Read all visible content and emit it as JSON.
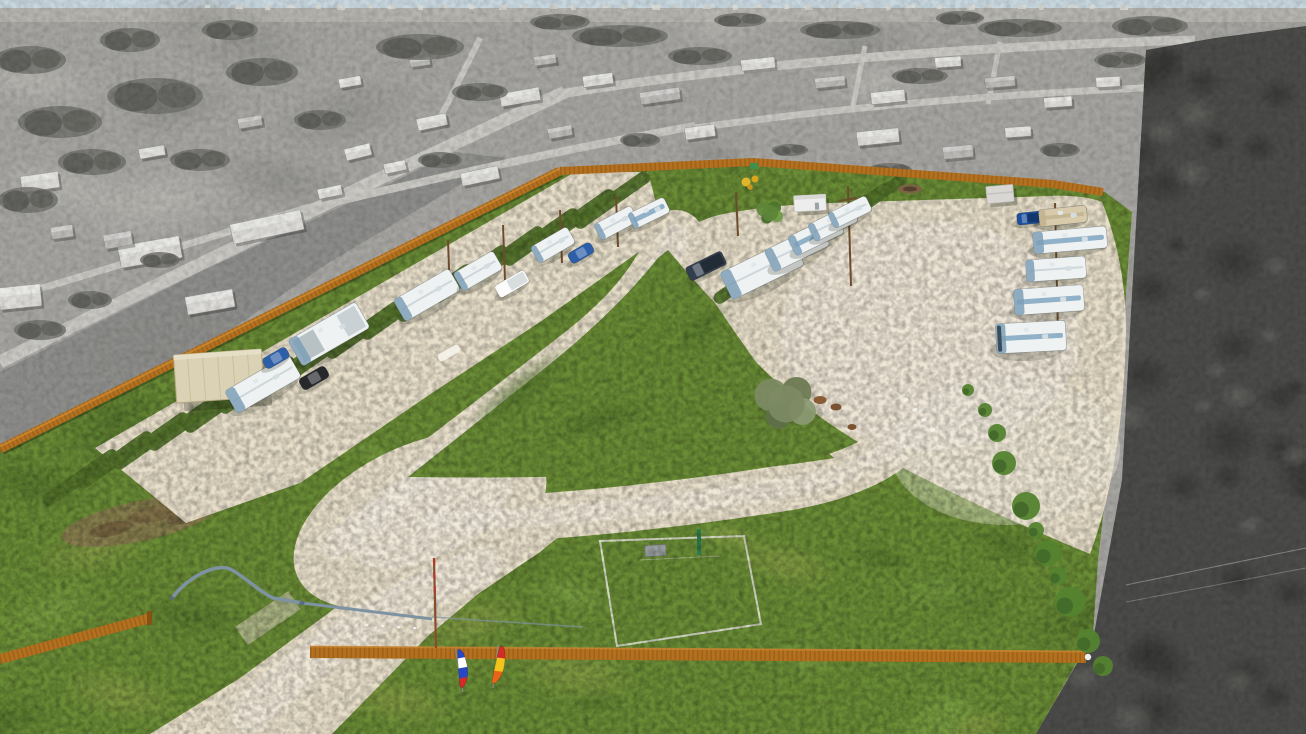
{
  "meta": {
    "description": "Aerial drone photograph of an RV park campground, shown in color while the surrounding rural neighborhood and woods are desaturated grayscale",
    "style": "color-pop isolation photo, no visible text"
  },
  "palette": {
    "sky": "#c8d6de",
    "field": "#a5a4a0",
    "fieldLight": "#b9b8b2",
    "asphalt": "#8b8b88",
    "road": "#c9c8c3",
    "bldgLight": "#deddd9",
    "bldgMid": "#bcbbb7",
    "gsTree": "#6f6f6b",
    "gsTreeDark": "#5b5b57",
    "woods": "#4b4b49",
    "woodsDark": "#383836",
    "woodsLight": "#656562",
    "grass": "#6a8c36",
    "grassDark": "#52702a",
    "grassLight": "#7da244",
    "grassYellow": "#8f9e4a",
    "gravel": "#e8dfca",
    "gravelLight": "#f3eee2",
    "fence": "#b3701f",
    "fenceDark": "#855114",
    "fenceLight": "#d08e38",
    "rvWhite": "#eff2f2",
    "rvTan": "#d8cbab",
    "accent": "#7fa6bf",
    "shadow": "rgba(30,35,20,0.38)",
    "carBlue": "#2d5fa8",
    "carBlack": "#26282b",
    "carWhite": "#fbfbfa",
    "truckDark": "#333f4e",
    "truckBlue": "#1c4f9c",
    "metal": "#7e93a2",
    "carportRoof": "#dbd2b6",
    "shed": "#d8d7d3",
    "office": "#ecedec",
    "poleBrown": "#6d4c2e",
    "debris": "#8b7852",
    "courtLine": "#e9e9e2",
    "postGreen": "#2f7d50",
    "sign": "#3f8f4f",
    "marking": "#f6f4ec"
  },
  "scene": {
    "gs_buildings": [
      [
        40,
        182,
        38,
        16,
        -8,
        "l"
      ],
      [
        150,
        252,
        62,
        22,
        -10,
        "l"
      ],
      [
        267,
        227,
        72,
        20,
        -12,
        "l"
      ],
      [
        20,
        297,
        42,
        22,
        -6,
        "l"
      ],
      [
        118,
        240,
        28,
        14,
        -10,
        "m"
      ],
      [
        358,
        152,
        26,
        12,
        -14,
        "l"
      ],
      [
        432,
        122,
        30,
        12,
        -12,
        "l"
      ],
      [
        520,
        97,
        40,
        13,
        -10,
        "l"
      ],
      [
        598,
        80,
        30,
        11,
        -8,
        "l"
      ],
      [
        660,
        96,
        40,
        12,
        -8,
        "m"
      ],
      [
        758,
        64,
        34,
        11,
        -6,
        "l"
      ],
      [
        830,
        82,
        30,
        10,
        -6,
        "m"
      ],
      [
        888,
        97,
        34,
        12,
        -6,
        "l"
      ],
      [
        948,
        62,
        26,
        10,
        -4,
        "l"
      ],
      [
        1000,
        82,
        30,
        10,
        -5,
        "m"
      ],
      [
        1058,
        102,
        28,
        10,
        -4,
        "l"
      ],
      [
        1108,
        82,
        24,
        10,
        -3,
        "l"
      ],
      [
        878,
        137,
        42,
        14,
        -6,
        "l"
      ],
      [
        958,
        152,
        30,
        12,
        -5,
        "m"
      ],
      [
        1018,
        132,
        26,
        10,
        -4,
        "l"
      ],
      [
        700,
        132,
        30,
        12,
        -8,
        "l"
      ],
      [
        560,
        132,
        24,
        10,
        -10,
        "m"
      ],
      [
        330,
        192,
        24,
        10,
        -12,
        "l"
      ],
      [
        395,
        167,
        22,
        10,
        -12,
        "l"
      ],
      [
        210,
        302,
        48,
        18,
        -10,
        "l"
      ],
      [
        480,
        176,
        38,
        13,
        -12,
        "l"
      ],
      [
        545,
        60,
        22,
        9,
        -8,
        "m"
      ],
      [
        420,
        62,
        20,
        8,
        -8,
        "m"
      ],
      [
        350,
        82,
        22,
        9,
        -10,
        "l"
      ],
      [
        250,
        122,
        24,
        10,
        -10,
        "m"
      ],
      [
        152,
        152,
        26,
        10,
        -10,
        "l"
      ],
      [
        62,
        232,
        22,
        12,
        -8,
        "m"
      ]
    ],
    "gs_trees": [
      [
        60,
        122,
        42,
        16
      ],
      [
        155,
        96,
        48,
        18
      ],
      [
        262,
        72,
        36,
        14
      ],
      [
        420,
        47,
        44,
        13
      ],
      [
        620,
        36,
        48,
        11
      ],
      [
        840,
        30,
        40,
        9
      ],
      [
        1020,
        28,
        42,
        9
      ],
      [
        1150,
        26,
        38,
        10
      ],
      [
        28,
        200,
        30,
        13
      ],
      [
        92,
        162,
        34,
        13
      ],
      [
        480,
        92,
        28,
        9
      ],
      [
        700,
        56,
        32,
        9
      ],
      [
        920,
        76,
        28,
        8
      ],
      [
        1120,
        60,
        26,
        8
      ],
      [
        200,
        160,
        30,
        11
      ],
      [
        320,
        120,
        26,
        10
      ],
      [
        30,
        60,
        36,
        14
      ],
      [
        130,
        40,
        30,
        12
      ],
      [
        230,
        30,
        28,
        10
      ],
      [
        560,
        22,
        30,
        8
      ],
      [
        740,
        20,
        26,
        7
      ],
      [
        960,
        18,
        24,
        7
      ],
      [
        440,
        160,
        22,
        8
      ],
      [
        640,
        140,
        20,
        7
      ],
      [
        790,
        150,
        18,
        6
      ],
      [
        1060,
        150,
        20,
        7
      ],
      [
        890,
        170,
        22,
        7
      ],
      [
        40,
        330,
        26,
        10
      ],
      [
        90,
        300,
        22,
        9
      ],
      [
        160,
        260,
        20,
        8
      ]
    ],
    "left_dividers": [
      [
        80,
        478
      ],
      [
        115,
        460
      ],
      [
        151,
        441
      ],
      [
        186,
        422
      ],
      [
        222,
        404
      ],
      [
        257,
        385
      ],
      [
        293,
        367
      ],
      [
        328,
        348
      ],
      [
        364,
        330
      ],
      [
        399,
        311
      ],
      [
        435,
        293
      ],
      [
        470,
        274
      ],
      [
        506,
        255
      ],
      [
        541,
        237
      ],
      [
        577,
        218
      ],
      [
        612,
        200
      ]
    ],
    "top_dividers": [
      [
        745,
        280
      ],
      [
        780,
        258
      ],
      [
        807,
        242
      ],
      [
        825,
        229
      ],
      [
        842,
        218
      ],
      [
        859,
        207
      ],
      [
        876,
        197
      ]
    ],
    "poles": [
      [
        448,
        240,
        450,
        296
      ],
      [
        503,
        225,
        505,
        280
      ],
      [
        560,
        210,
        562,
        263
      ],
      [
        616,
        196,
        618,
        247
      ],
      [
        848,
        186,
        851,
        286
      ],
      [
        1055,
        203,
        1058,
        333
      ],
      [
        736,
        192,
        738,
        236
      ]
    ],
    "objects": [
      {
        "t": "carport",
        "x": 219,
        "y": 376,
        "w": 88,
        "h": 48,
        "a": -4
      },
      {
        "t": "rv",
        "x": 263,
        "y": 384,
        "w": 74,
        "h": 26,
        "a": -30,
        "v": "white"
      },
      {
        "t": "car",
        "x": 276,
        "y": 358,
        "w": 27,
        "h": 12,
        "a": -30,
        "v": "blue"
      },
      {
        "t": "car",
        "x": 314,
        "y": 378,
        "w": 30,
        "h": 13,
        "a": -30,
        "v": "black"
      },
      {
        "t": "rv",
        "x": 329,
        "y": 334,
        "w": 78,
        "h": 30,
        "a": -30,
        "v": "gray"
      },
      {
        "t": "rv",
        "x": 427,
        "y": 295,
        "w": 64,
        "h": 25,
        "a": -30,
        "v": "white"
      },
      {
        "t": "rv",
        "x": 478,
        "y": 271,
        "w": 46,
        "h": 21,
        "a": -30,
        "v": "white"
      },
      {
        "t": "truck",
        "x": 512,
        "y": 284,
        "w": 34,
        "h": 14,
        "a": -30,
        "v": "white"
      },
      {
        "t": "rv",
        "x": 553,
        "y": 245,
        "w": 42,
        "h": 19,
        "a": -30,
        "v": "white"
      },
      {
        "t": "car",
        "x": 581,
        "y": 253,
        "w": 26,
        "h": 12,
        "a": -30,
        "v": "blue"
      },
      {
        "t": "rv",
        "x": 616,
        "y": 223,
        "w": 42,
        "h": 18,
        "a": -28,
        "v": "white"
      },
      {
        "t": "rv",
        "x": 649,
        "y": 213,
        "w": 40,
        "h": 17,
        "a": -26,
        "v": "blue"
      },
      {
        "t": "truck",
        "x": 706,
        "y": 266,
        "w": 40,
        "h": 15,
        "a": -26,
        "v": "dark"
      },
      {
        "t": "rv",
        "x": 762,
        "y": 269,
        "w": 80,
        "h": 30,
        "a": -26,
        "v": "white"
      },
      {
        "t": "rv",
        "x": 797,
        "y": 248,
        "w": 62,
        "h": 24,
        "a": -26,
        "v": "white"
      },
      {
        "t": "rv",
        "x": 816,
        "y": 235,
        "w": 54,
        "h": 21,
        "a": -26,
        "v": "blue"
      },
      {
        "t": "rv",
        "x": 833,
        "y": 223,
        "w": 48,
        "h": 19,
        "a": -26,
        "v": "white"
      },
      {
        "t": "rv",
        "x": 850,
        "y": 212,
        "w": 42,
        "h": 17,
        "a": -26,
        "v": "white"
      },
      {
        "t": "office",
        "x": 810,
        "y": 203,
        "w": 32,
        "h": 16,
        "a": -3
      },
      {
        "t": "shed",
        "x": 1000,
        "y": 194,
        "w": 27,
        "h": 17,
        "a": -5
      },
      {
        "t": "playground",
        "x": 750,
        "y": 183
      },
      {
        "t": "firepit",
        "x": 910,
        "y": 189
      },
      {
        "t": "truck",
        "x": 1030,
        "y": 218,
        "w": 26,
        "h": 12,
        "a": -6,
        "v": "blue"
      },
      {
        "t": "rv",
        "x": 1063,
        "y": 216,
        "w": 48,
        "h": 17,
        "a": -6,
        "v": "tan"
      },
      {
        "t": "rv",
        "x": 1070,
        "y": 240,
        "w": 74,
        "h": 22,
        "a": -5,
        "v": "blue"
      },
      {
        "t": "rv",
        "x": 1056,
        "y": 269,
        "w": 60,
        "h": 22,
        "a": -4,
        "v": "white"
      },
      {
        "t": "rv",
        "x": 1049,
        "y": 300,
        "w": 70,
        "h": 26,
        "a": -4,
        "v": "blue"
      },
      {
        "t": "rv",
        "x": 1031,
        "y": 337,
        "w": 70,
        "h": 30,
        "a": -3,
        "v": "motor"
      },
      {
        "t": "marking",
        "x": 449,
        "y": 353,
        "w": 24,
        "h": 8,
        "a": -30
      }
    ],
    "trees": [
      {
        "x": 786,
        "y": 404,
        "r": 30,
        "v": "sage"
      },
      {
        "x": 770,
        "y": 213,
        "r": 13,
        "v": "green"
      }
    ],
    "bushes": [
      [
        997,
        433,
        9
      ],
      [
        1004,
        463,
        12
      ],
      [
        1026,
        506,
        14
      ],
      [
        1048,
        553,
        13
      ],
      [
        1070,
        602,
        15
      ],
      [
        1088,
        641,
        12
      ],
      [
        1103,
        666,
        10
      ],
      [
        985,
        410,
        7
      ],
      [
        1058,
        576,
        9
      ],
      [
        1036,
        530,
        8
      ],
      [
        968,
        390,
        6
      ]
    ],
    "chairs": [
      [
        903,
        399
      ],
      [
        912,
        409
      ],
      [
        921,
        419
      ],
      [
        930,
        429
      ]
    ],
    "animals": [
      [
        820,
        400
      ],
      [
        836,
        407
      ],
      [
        852,
        427
      ]
    ],
    "flags": [
      {
        "x": 463,
        "y": 692,
        "lean": -10,
        "bands": [
          "#2746c8",
          "#ffffff",
          "#2746c8",
          "#d42a28"
        ]
      },
      {
        "x": 493,
        "y": 688,
        "lean": 7,
        "bands": [
          "#d42a28",
          "#f3c41c",
          "#ea6418"
        ]
      }
    ]
  }
}
